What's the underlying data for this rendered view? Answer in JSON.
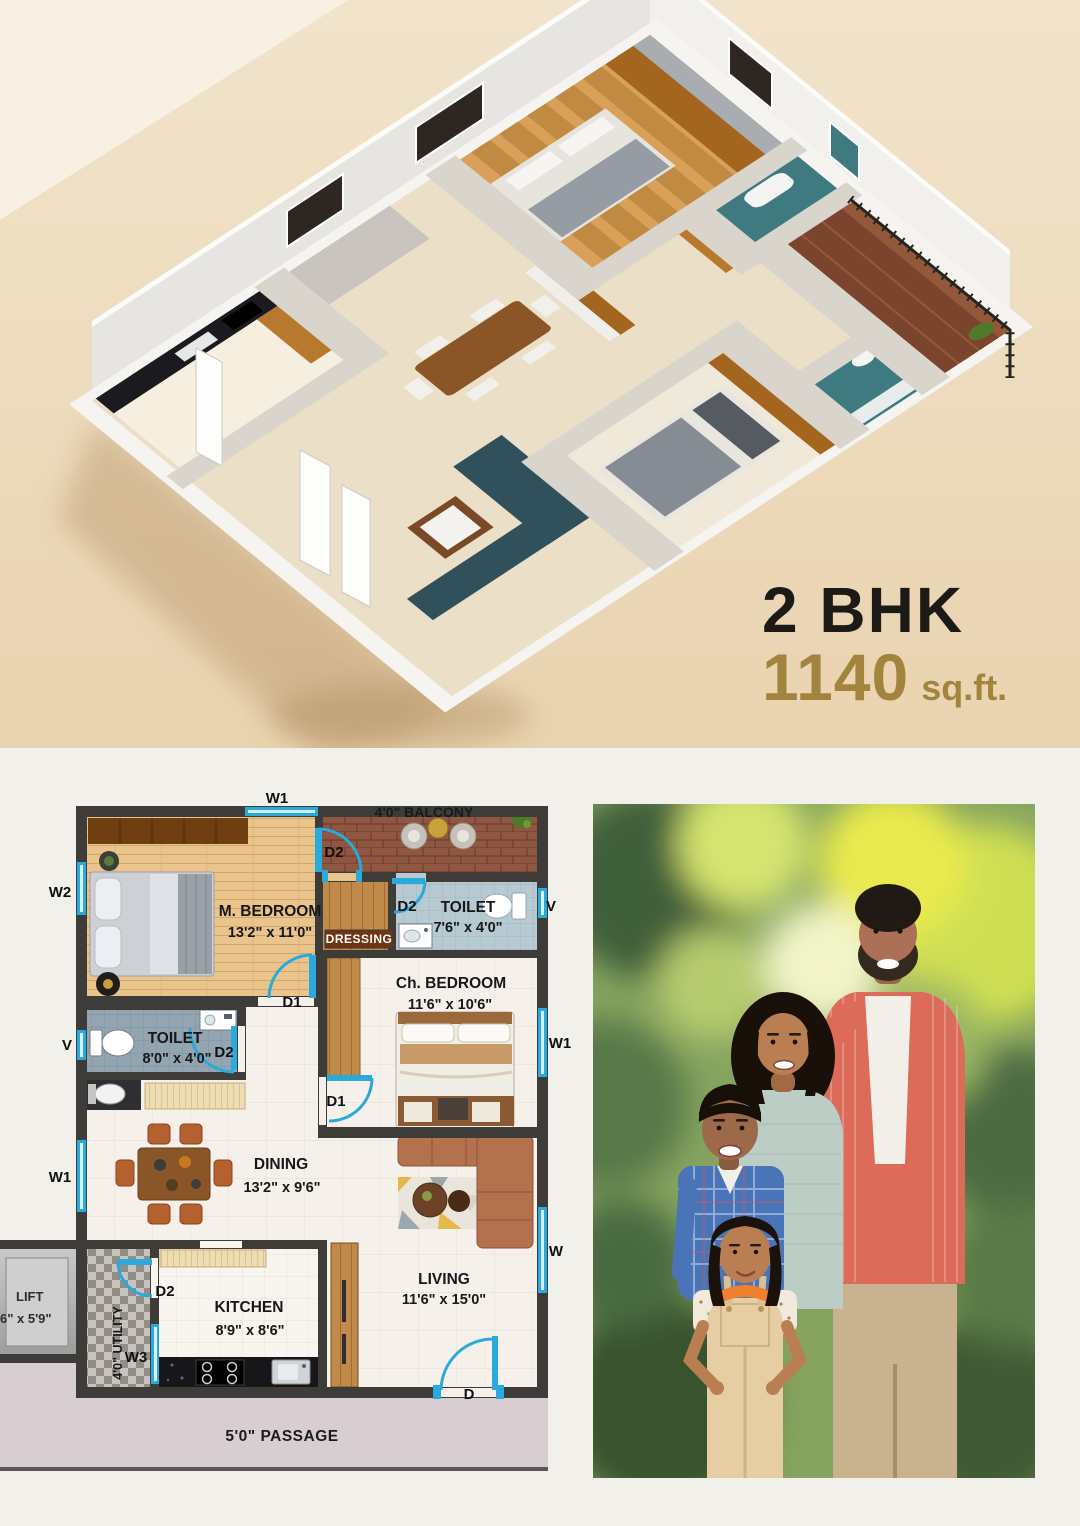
{
  "hero": {
    "unit_type": "2 BHK",
    "area_value": "1140",
    "area_unit": "sq.ft."
  },
  "floor_plan": {
    "rooms": {
      "m_bedroom": {
        "name": "M. BEDROOM",
        "dims": "13'2\" x 11'0\""
      },
      "balcony": {
        "name": "4'0\" BALCONY"
      },
      "toilet_attached": {
        "name": "TOILET",
        "dims": "7'6\" x 4'0\""
      },
      "dressing": {
        "name": "DRESSING"
      },
      "ch_bedroom": {
        "name": "Ch. BEDROOM",
        "dims": "11'6\" x 10'6\""
      },
      "toilet_common": {
        "name": "TOILET",
        "dims": "8'0\" x 4'0\""
      },
      "dining": {
        "name": "DINING",
        "dims": "13'2\" x 9'6\""
      },
      "kitchen": {
        "name": "KITCHEN",
        "dims": "8'9\" x 8'6\""
      },
      "utility": {
        "name": "4'0\" UTILITY"
      },
      "living": {
        "name": "LIVING",
        "dims": "11'6\" x 15'0\""
      },
      "lift": {
        "name": "LIFT",
        "dims": "6\" x 5'9\""
      },
      "passage": {
        "name": "5'0\" PASSAGE"
      }
    },
    "markers": {
      "w": "W",
      "w1": "W1",
      "w2": "W2",
      "w3": "W3",
      "v": "V",
      "d": "D",
      "d1": "D1",
      "d2": "D2"
    }
  },
  "colors": {
    "hero_background": "#ecd9ba",
    "accent_gold": "#a2843c",
    "plan_wall": "#3d3c39",
    "plan_fixture_blue": "#29a9dc"
  }
}
